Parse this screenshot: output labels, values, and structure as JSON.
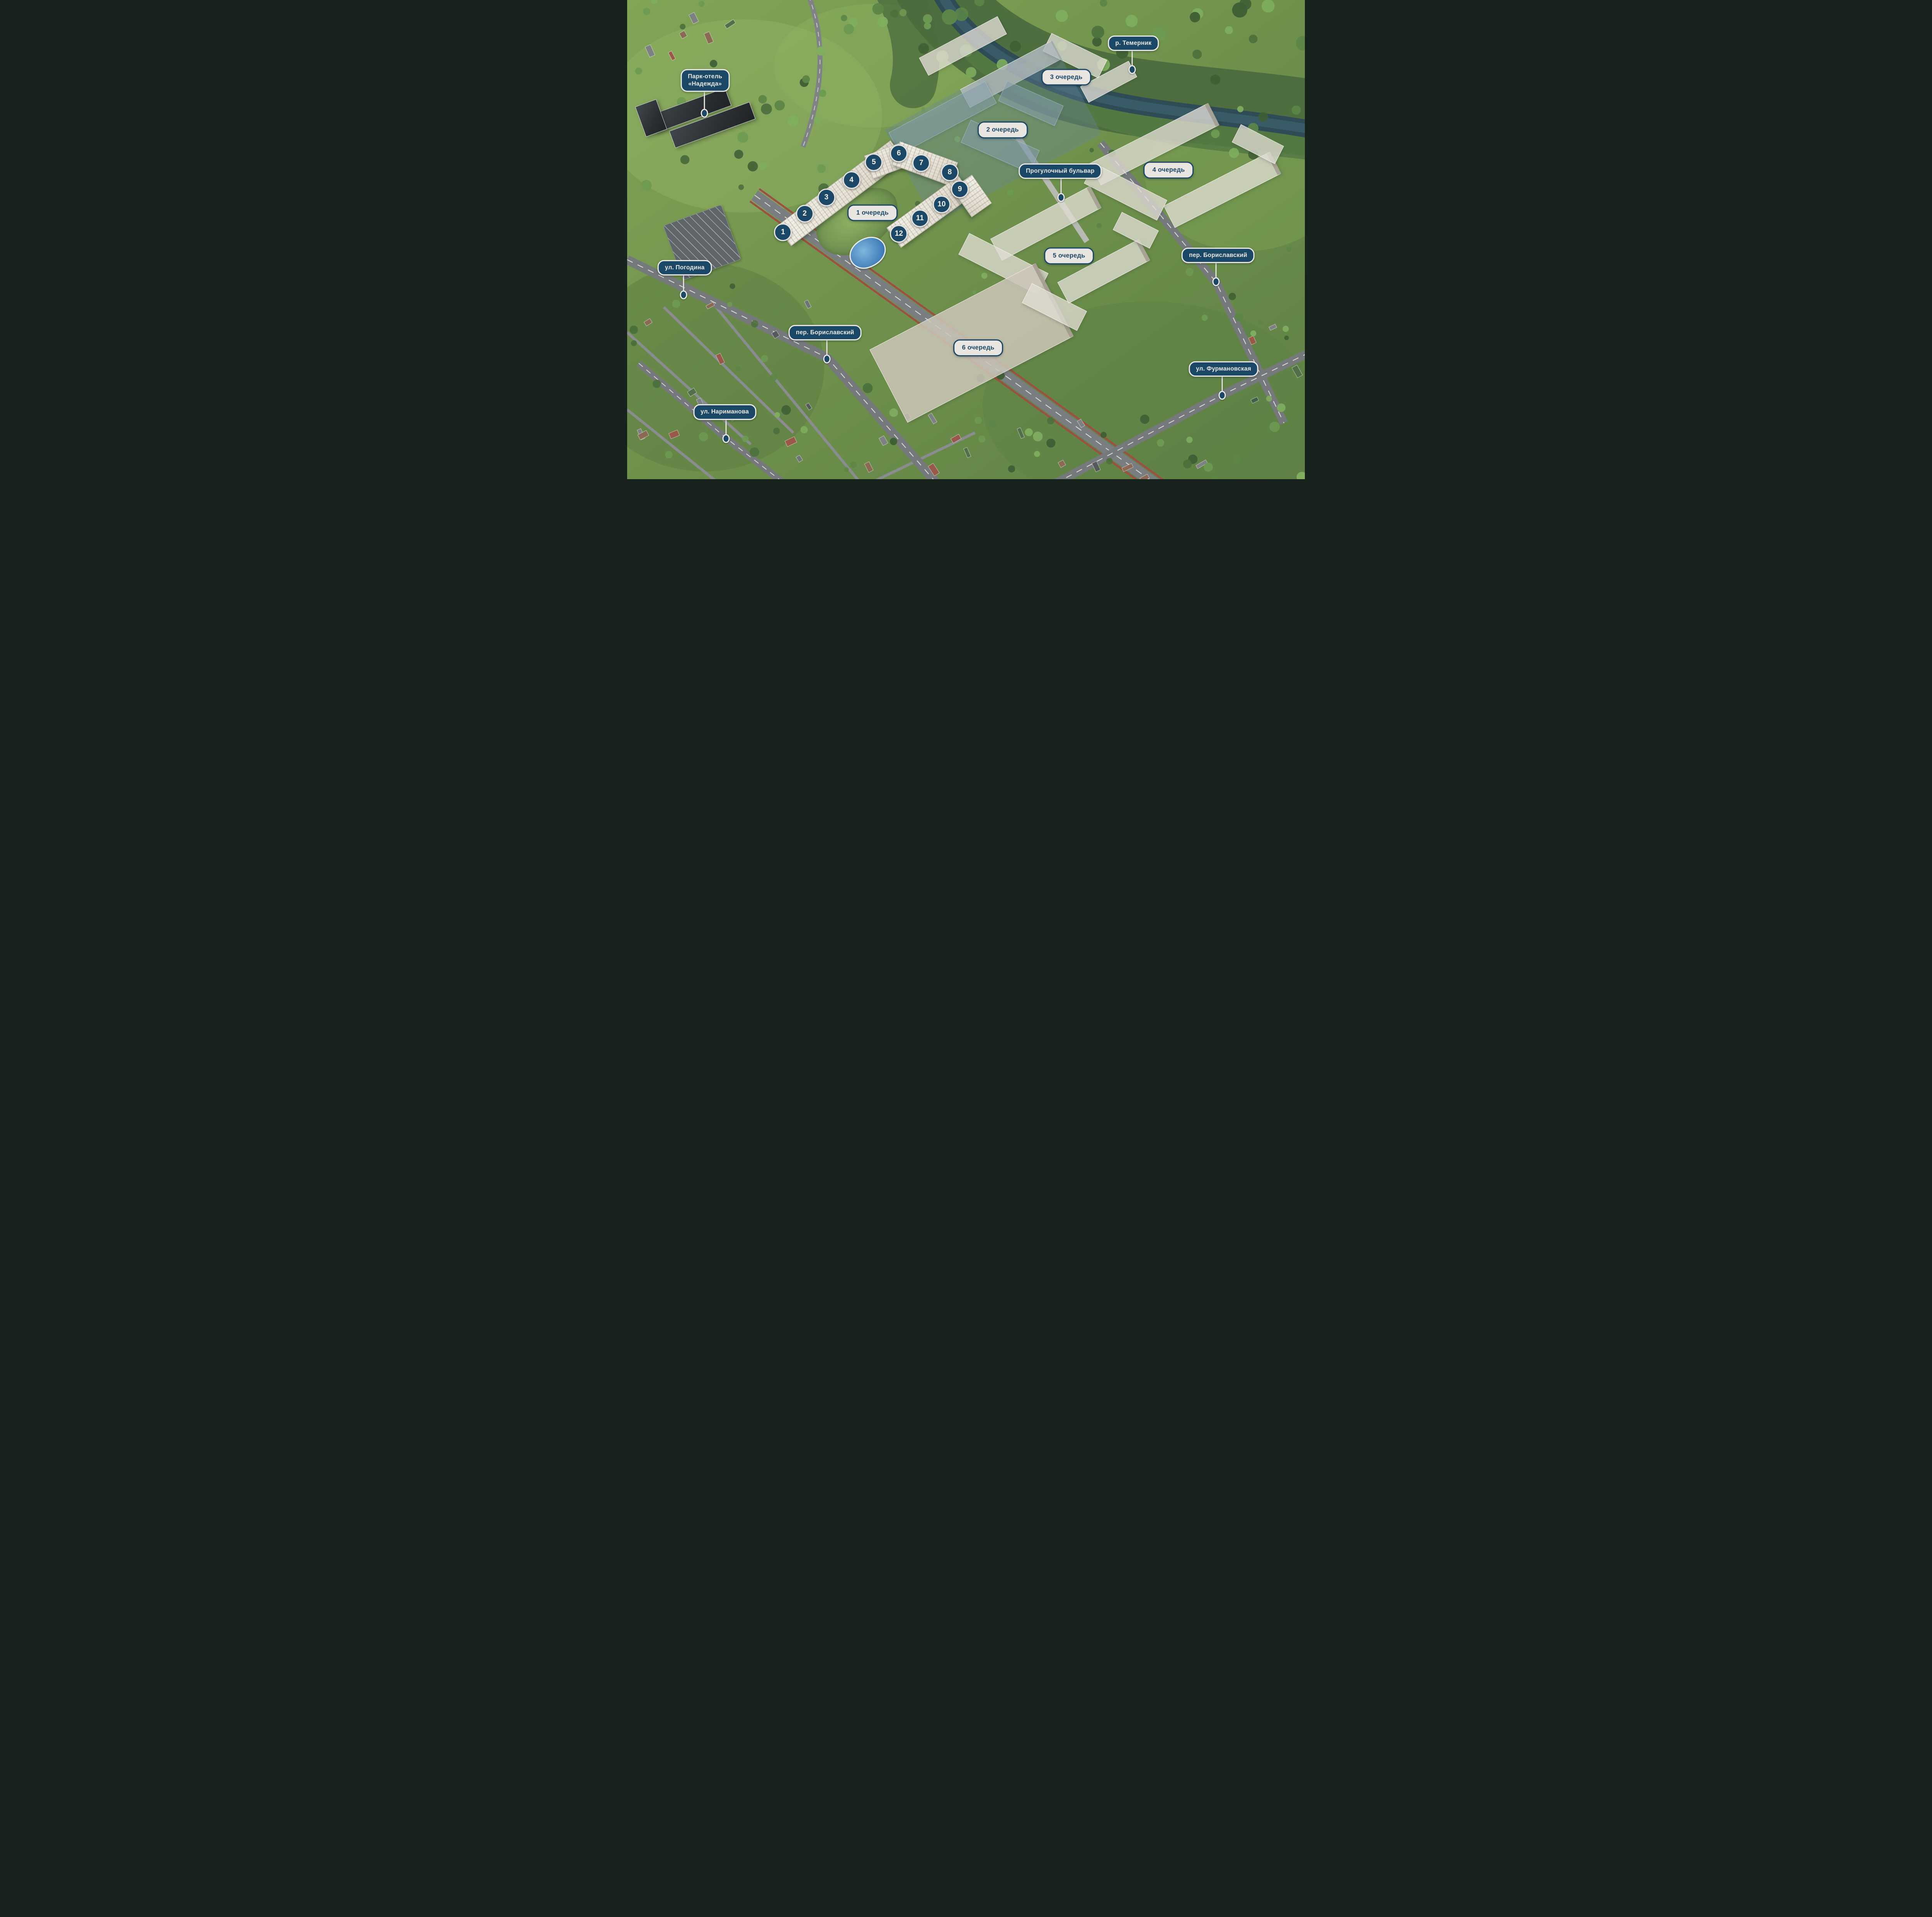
{
  "colors": {
    "navy": "#1c4868",
    "pill_light_bg": "#e9e6e1",
    "pill_ring": "#eceae5",
    "river": "#2e4b56",
    "road_grey": "#75797b",
    "bike_lane_red": "#9d4f43",
    "ground_green": "#6f914c",
    "forest_green": "#4c6b3e",
    "ghost_building": "#e0ddd3",
    "phase2_overlay": "#68859c",
    "phase1_facade": "#ece8dd",
    "pool_blue": "#3d7ab8"
  },
  "map": {
    "phase_labels": [
      {
        "id": "phase-1",
        "label": "1 очередь",
        "x": 36.2,
        "y": 44.4
      },
      {
        "id": "phase-2",
        "label": "2 очередь",
        "x": 55.4,
        "y": 27.1
      },
      {
        "id": "phase-3",
        "label": "3 очередь",
        "x": 64.8,
        "y": 16.1
      },
      {
        "id": "phase-4",
        "label": "4 очередь",
        "x": 79.9,
        "y": 35.5
      },
      {
        "id": "phase-5",
        "label": "5 очередь",
        "x": 65.2,
        "y": 53.4
      },
      {
        "id": "phase-6",
        "label": "6 очередь",
        "x": 51.8,
        "y": 72.6
      }
    ],
    "place_labels": [
      {
        "id": "river-temernik",
        "label": "р. Темерник",
        "x": 74.7,
        "y": 9.0,
        "pin_x": 74.5,
        "pin_y": 14.5
      },
      {
        "id": "park-hotel-nadezhda",
        "label": "Парк-отель\n«Надежда»",
        "x": 11.5,
        "y": 16.8,
        "pin_x": 11.4,
        "pin_y": 23.6
      },
      {
        "id": "progulochny-bulvar",
        "label": "Прогулочный бульвар",
        "x": 63.9,
        "y": 35.7,
        "pin_x": 64.0,
        "pin_y": 41.2
      },
      {
        "id": "per-borislavskiy-east",
        "label": "пер. Бориславский",
        "x": 87.2,
        "y": 53.3,
        "pin_x": 86.9,
        "pin_y": 58.8
      },
      {
        "id": "ul-pogodina",
        "label": "ул. Погодина",
        "x": 8.5,
        "y": 55.9,
        "pin_x": 8.3,
        "pin_y": 61.5
      },
      {
        "id": "per-borislavskiy-west",
        "label": "пер. Бориславский",
        "x": 29.2,
        "y": 69.4,
        "pin_x": 29.5,
        "pin_y": 74.9
      },
      {
        "id": "ul-furmanovskaya",
        "label": "ул. Фурмановская",
        "x": 88.0,
        "y": 77.0,
        "pin_x": 87.8,
        "pin_y": 82.5
      },
      {
        "id": "ul-narimanova",
        "label": "ул. Нариманова",
        "x": 14.4,
        "y": 86.0,
        "pin_x": 14.6,
        "pin_y": 91.5
      }
    ],
    "building_markers": [
      {
        "n": "1",
        "x": 23.0,
        "y": 48.5
      },
      {
        "n": "2",
        "x": 26.2,
        "y": 44.6
      },
      {
        "n": "3",
        "x": 29.4,
        "y": 41.2
      },
      {
        "n": "4",
        "x": 33.1,
        "y": 37.6
      },
      {
        "n": "5",
        "x": 36.4,
        "y": 33.9
      },
      {
        "n": "6",
        "x": 40.1,
        "y": 32.0
      },
      {
        "n": "7",
        "x": 43.4,
        "y": 34.0
      },
      {
        "n": "8",
        "x": 47.6,
        "y": 36.0
      },
      {
        "n": "9",
        "x": 49.1,
        "y": 39.5
      },
      {
        "n": "10",
        "x": 46.4,
        "y": 42.7
      },
      {
        "n": "11",
        "x": 43.2,
        "y": 45.6
      },
      {
        "n": "12",
        "x": 40.1,
        "y": 48.8
      }
    ]
  }
}
